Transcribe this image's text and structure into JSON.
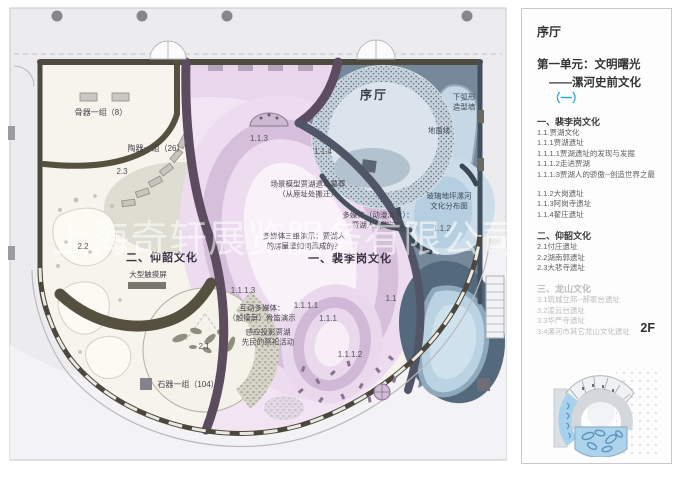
{
  "watermark": "上海奇轩展览服务有限公司",
  "colors": {
    "accent": "#29abe2",
    "minimap_highlight": "#aed3ec",
    "plan_pink": "#f2e4f3",
    "plan_blue": "#76899a"
  },
  "plan": {
    "hall_label": "序厅",
    "zone1_title": "一、裴李岗文化",
    "zone2_title": "二、仰韶文化",
    "bone_group": "骨器一组（8）",
    "pottery_group": "陶器一组（26）",
    "stone_group": "石器一组（104）",
    "touchscreen": "大型触摸屏",
    "scene_model_l1": "场景模型贾湖遗址墓葬",
    "scene_model_l2": "（从原址处搬迁）",
    "mm_anim_l1": "多媒体（动漫演示）：",
    "mm_anim_l2": "贾湖人制陶过程",
    "mm_3d_l1": "多媒体三维演示：贾湖人",
    "mm_3d_l2": "的房屋是如何建成的？",
    "interactive_l1": "互动多媒体：",
    "interactive_l2": "（触摸屏）骨笛演示",
    "projection_l1": "感应投影贾湖",
    "projection_l2": "先民的祭祀活动",
    "arc_wall_l1": "下弧形",
    "arc_wall_l2": "造型墙",
    "ground_line": "地面线",
    "glass_floor_l1": "玻璃地坪漯河",
    "glass_floor_l2": "文化分布图",
    "codes": {
      "c23": "2.3",
      "c22": "2.2",
      "c21": "2.1",
      "c113": "1.1.3",
      "c114": "1.1.4",
      "c112": "1.1.2",
      "c1113": "1.1.1.3",
      "c1111": "1.1.1.1",
      "c111": "1.1.1",
      "c11": "1.1",
      "c1112": "1.1.1.2"
    }
  },
  "sidebar": {
    "hall": "序厅",
    "unit_line1": "第一单元：文明曙光",
    "unit_line2": "——漯河史前文化",
    "unit_paren": "（一）",
    "floor": "2F",
    "sections": [
      {
        "title": "一、裴李岗文化",
        "groups": [
          [
            "1.1.贾湖文化",
            "1.1.1贾湖遗址",
            "1.1.1.1贾湖遗址的发现与发掘",
            "1.1.1.2走进贾湖",
            "1.1.1.3贾湖人的骄傲--创造世界之最"
          ],
          [
            "1.1.2大岗遗址",
            "1.1.3阿岗寺遗址",
            "1.1.4翟庄遗址"
          ]
        ]
      },
      {
        "title": "二、仰韶文化",
        "groups": [
          [
            "2.1付庄遗址",
            "2.2湖南郭遗址",
            "2.3大悲寺遗址"
          ]
        ]
      },
      {
        "title": "三、龙山文化",
        "muted": true,
        "groups": [
          [
            "3.1筑城立邦--郝家台遗址",
            "3.2凌云台遗址",
            "3.3华严寺遗址",
            "3.4漯河市其它龙山文化遗址"
          ]
        ]
      }
    ]
  }
}
